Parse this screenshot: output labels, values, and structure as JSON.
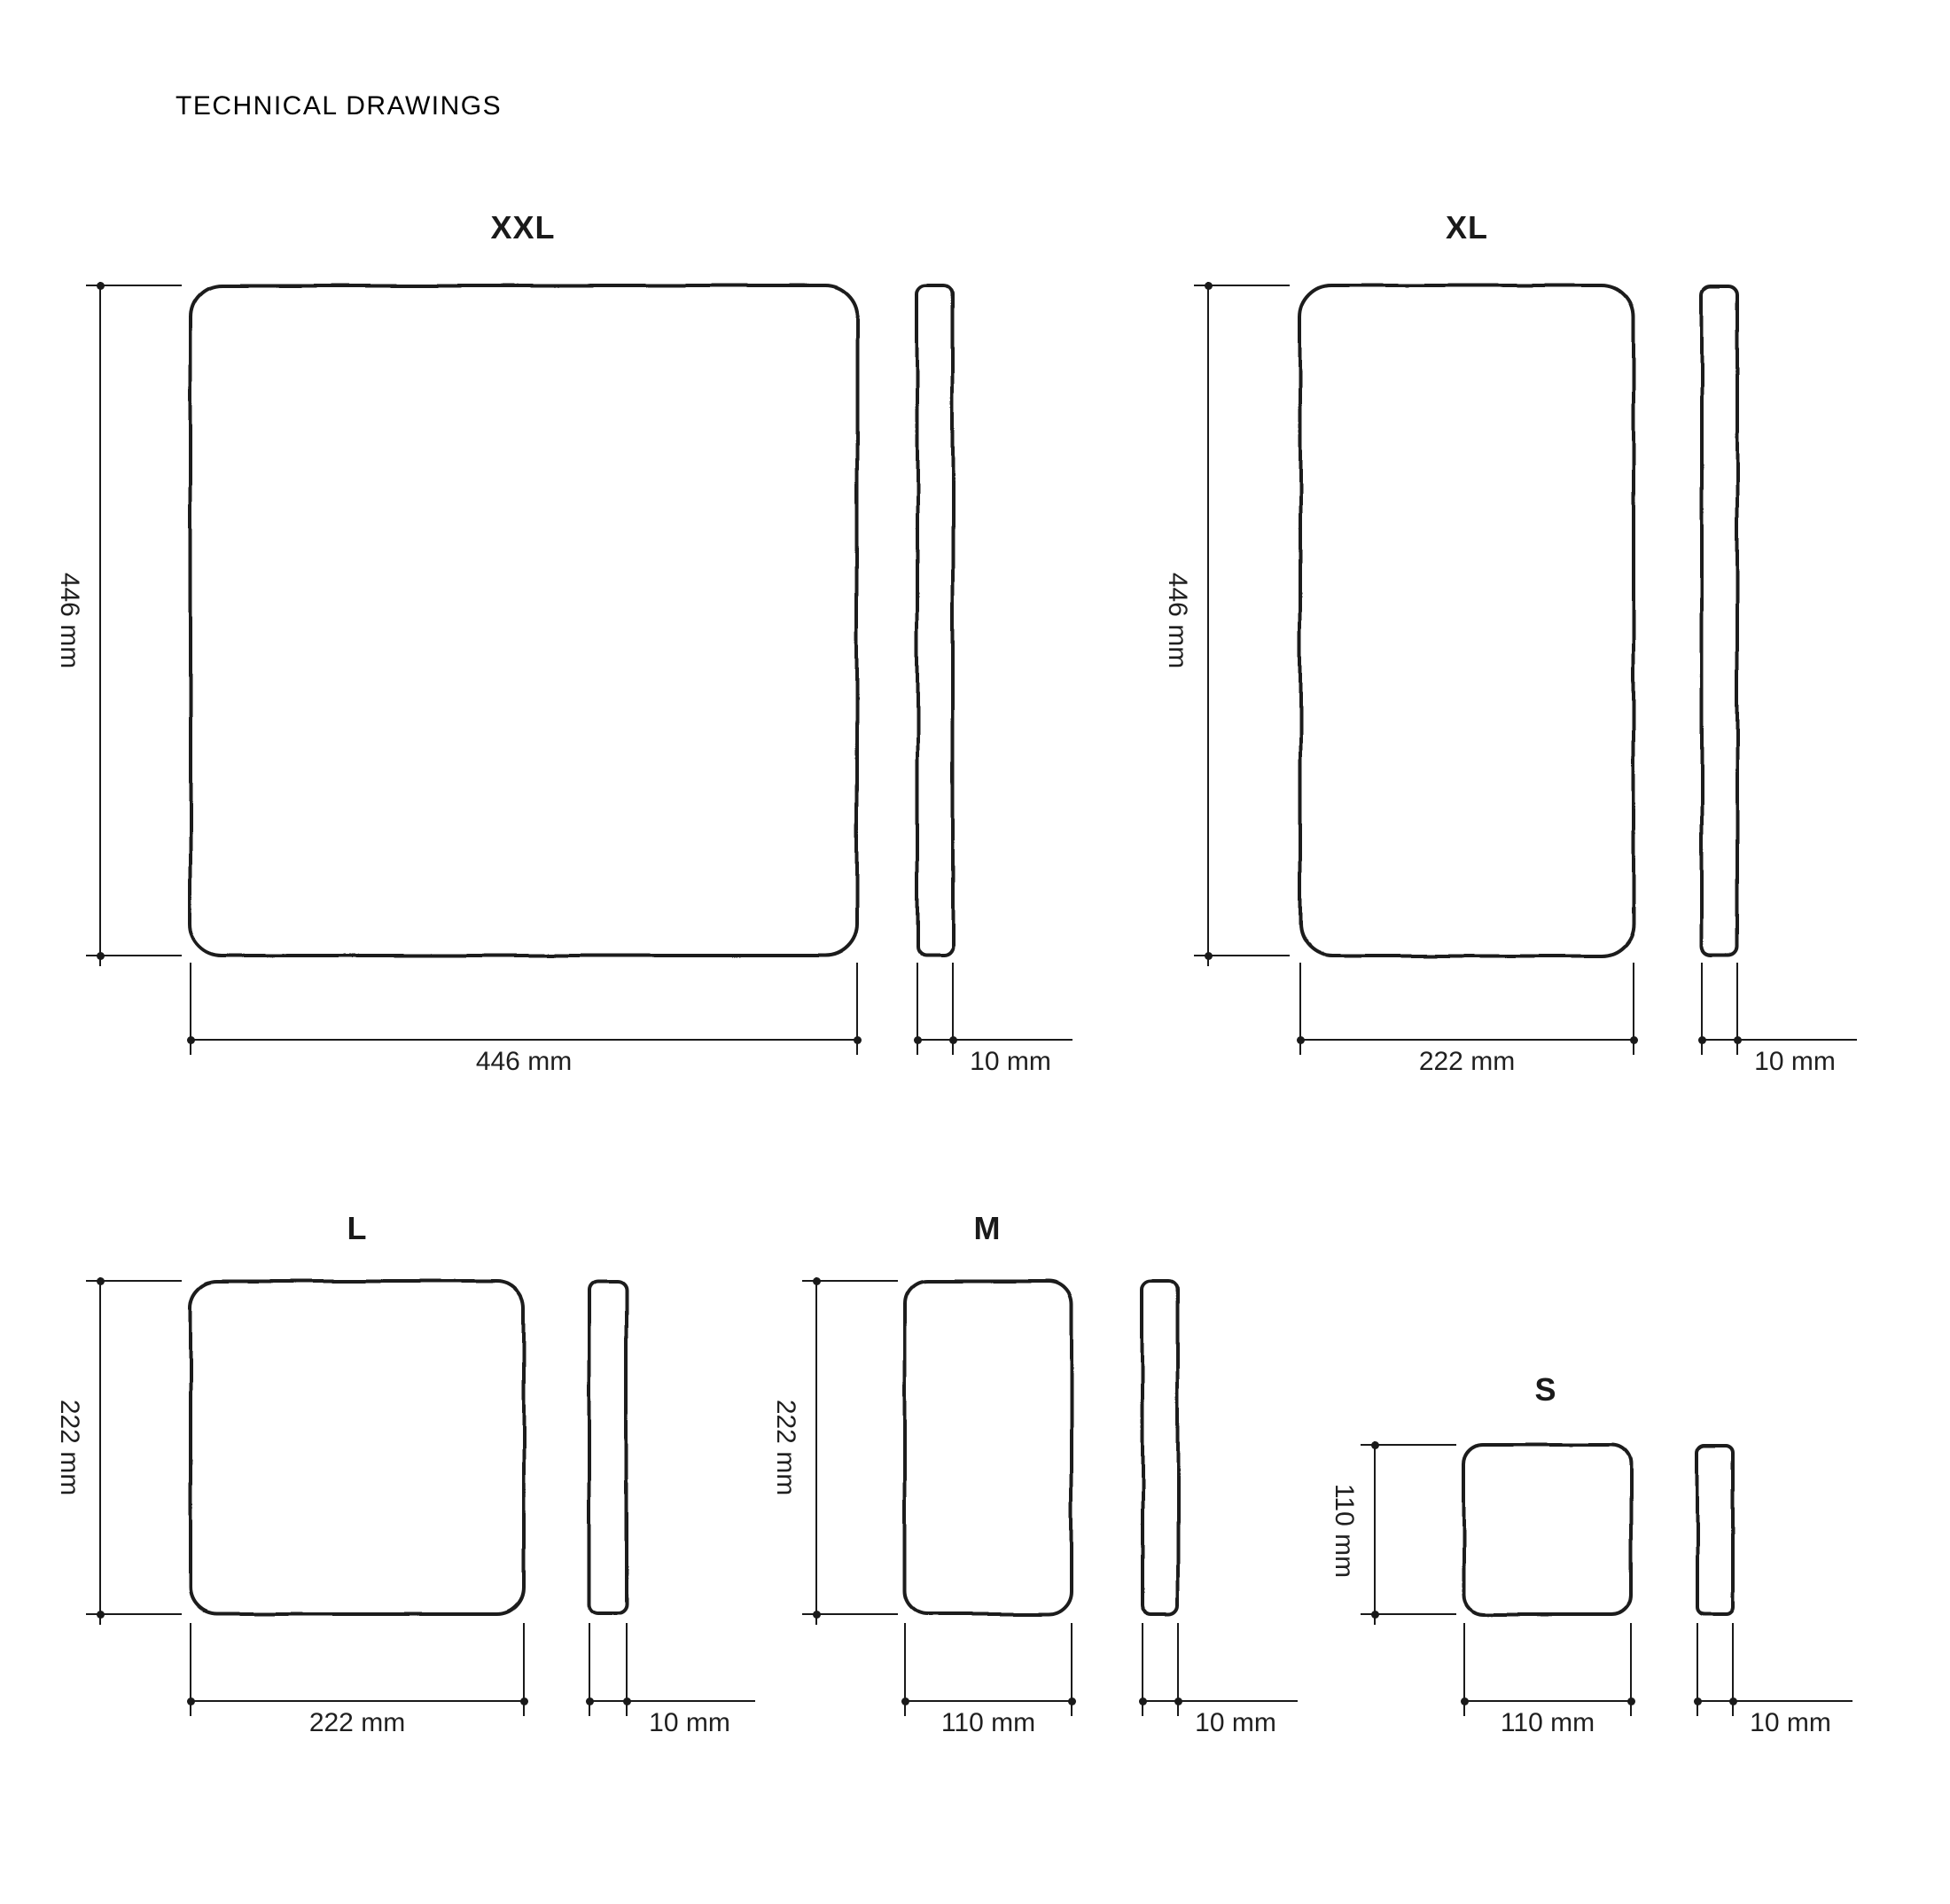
{
  "page": {
    "title": "TECHNICAL DRAWINGS"
  },
  "colors": {
    "background": "#ffffff",
    "line": "#1a1a1a",
    "text": "#1f1f1f"
  },
  "drawings": [
    {
      "label": "XXL",
      "height": "446 mm",
      "width": "446 mm",
      "thickness": "10 mm"
    },
    {
      "label": "XL",
      "height": "446 mm",
      "width": "222 mm",
      "thickness": "10 mm"
    },
    {
      "label": "L",
      "height": "222 mm",
      "width": "222 mm",
      "thickness": "10 mm"
    },
    {
      "label": "M",
      "height": "222 mm",
      "width": "110 mm",
      "thickness": "10 mm"
    },
    {
      "label": "S",
      "height": "110 mm",
      "width": "110 mm",
      "thickness": "10 mm"
    }
  ]
}
